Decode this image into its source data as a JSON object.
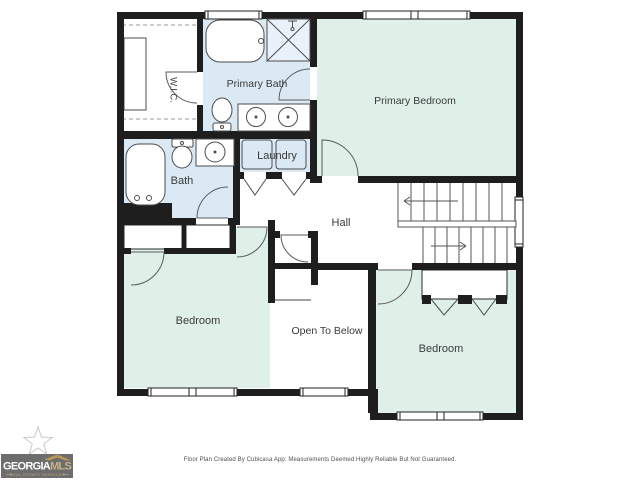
{
  "rooms": {
    "wic": {
      "label": "W.I.C."
    },
    "primary_bath": {
      "label": "Primary Bath"
    },
    "primary_bedroom": {
      "label": "Primary Bedroom"
    },
    "laundry": {
      "label": "Laundry"
    },
    "bath": {
      "label": "Bath"
    },
    "hall": {
      "label": "Hall"
    },
    "bedroom_left": {
      "label": "Bedroom"
    },
    "open_to_below": {
      "label": "Open To Below"
    },
    "bedroom_right": {
      "label": "Bedroom"
    }
  },
  "footer": {
    "disclaimer": "Floor Plan Created By Cubicasa App: Measurements Deemed Highly Reliable But Not Guaranteed."
  },
  "logo": {
    "brand_primary": "GEORGIA",
    "brand_secondary": "MLS",
    "tagline": "REAL ESTATE SERVICES"
  },
  "colors": {
    "wall": "#1e1e1e",
    "wet_room_fill": "#dbe9f4",
    "bedroom_fill": "#dff0e8",
    "fixture_stroke": "#4d4d4d",
    "label_text": "#3a3a3a",
    "logo_background": "#6d6d6d",
    "logo_gold": "#bfa06a"
  }
}
